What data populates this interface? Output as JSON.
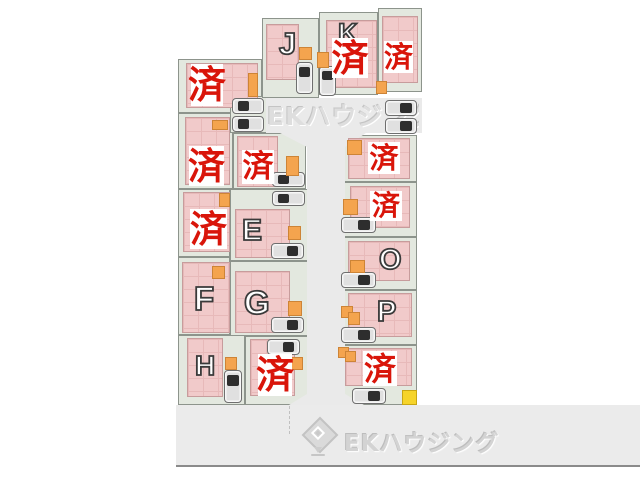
{
  "branding": {
    "watermark": "EKハウジング",
    "footer_logo_text": "EKハウジング",
    "footer_logo_icon": "ek-diamond-logo-icon"
  },
  "legend": {
    "sold_stamp_character": "済"
  },
  "lots": {
    "a": {
      "status": "済"
    },
    "b": {
      "status": "済"
    },
    "c": {
      "status": "済"
    },
    "d": {
      "status": "済"
    },
    "e": {
      "label": "E"
    },
    "f": {
      "label": "F"
    },
    "g": {
      "label": "G"
    },
    "h": {
      "label": "H"
    },
    "i": {
      "status": "済"
    },
    "j": {
      "label": "J"
    },
    "k": {
      "label": "K",
      "status": "済"
    },
    "l": {
      "status": "済"
    },
    "m": {
      "status": "済"
    },
    "n": {
      "status": "済"
    },
    "o": {
      "label": "O"
    },
    "p": {
      "label": "P"
    },
    "q": {
      "status": "済"
    }
  },
  "icons": {
    "car": "car-icon",
    "storage_marker": "orange-marker-icon",
    "utility_marker": "yellow-marker-icon",
    "logo": "ek-diamond-logo-icon"
  },
  "colors": {
    "building": "#f1caca",
    "ground": "#e3e8df",
    "road": "#eaeaea",
    "marker_orange": "#f4a44e",
    "marker_yellow": "#f6d42a",
    "stamp_red": "#d9150a",
    "footer_band": "#ebebeb"
  }
}
